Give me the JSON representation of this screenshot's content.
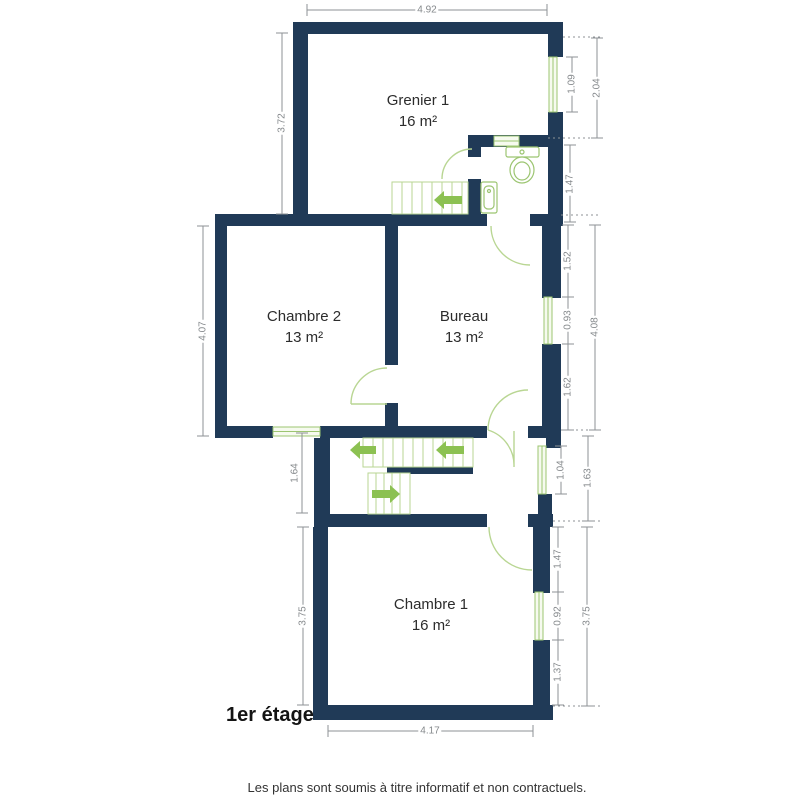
{
  "plan": {
    "floor_label": "1er étage",
    "disclaimer": "Les plans sont soumis à titre informatif et non contractuels."
  },
  "rooms": [
    {
      "id": "grenier-1",
      "name": "Grenier 1",
      "area": "16 m²"
    },
    {
      "id": "chambre-2",
      "name": "Chambre 2",
      "area": "13 m²"
    },
    {
      "id": "bureau",
      "name": "Bureau",
      "area": "13 m²"
    },
    {
      "id": "chambre-1",
      "name": "Chambre 1",
      "area": "16 m²"
    }
  ],
  "dims": {
    "top_width": "4.92",
    "grenier_left": "3.72",
    "chambre2_left": "4.07",
    "landing_left": "1.64",
    "chambre1_left": "3.75",
    "grenier_window": "1.09",
    "grenier_right_total": "2.04",
    "wc_right": "1.47",
    "bureau_upper": "1.52",
    "bureau_window": "0.93",
    "bureau_lower": "1.62",
    "bureau_total": "4.08",
    "hall_window": "1.04",
    "hall_total": "1.63",
    "chambre1_upper": "1.47",
    "chambre1_window": "0.92",
    "chambre1_lower": "1.37",
    "chambre1_right_total": "3.75",
    "chambre1_bottom": "4.17"
  },
  "colors": {
    "wall": "#203a57",
    "green_accent": "#8cc152",
    "green_medium": "#9cc571",
    "green_light": "#b9d693",
    "dimension_line": "#8d9296",
    "text": "#2c2c2c"
  }
}
